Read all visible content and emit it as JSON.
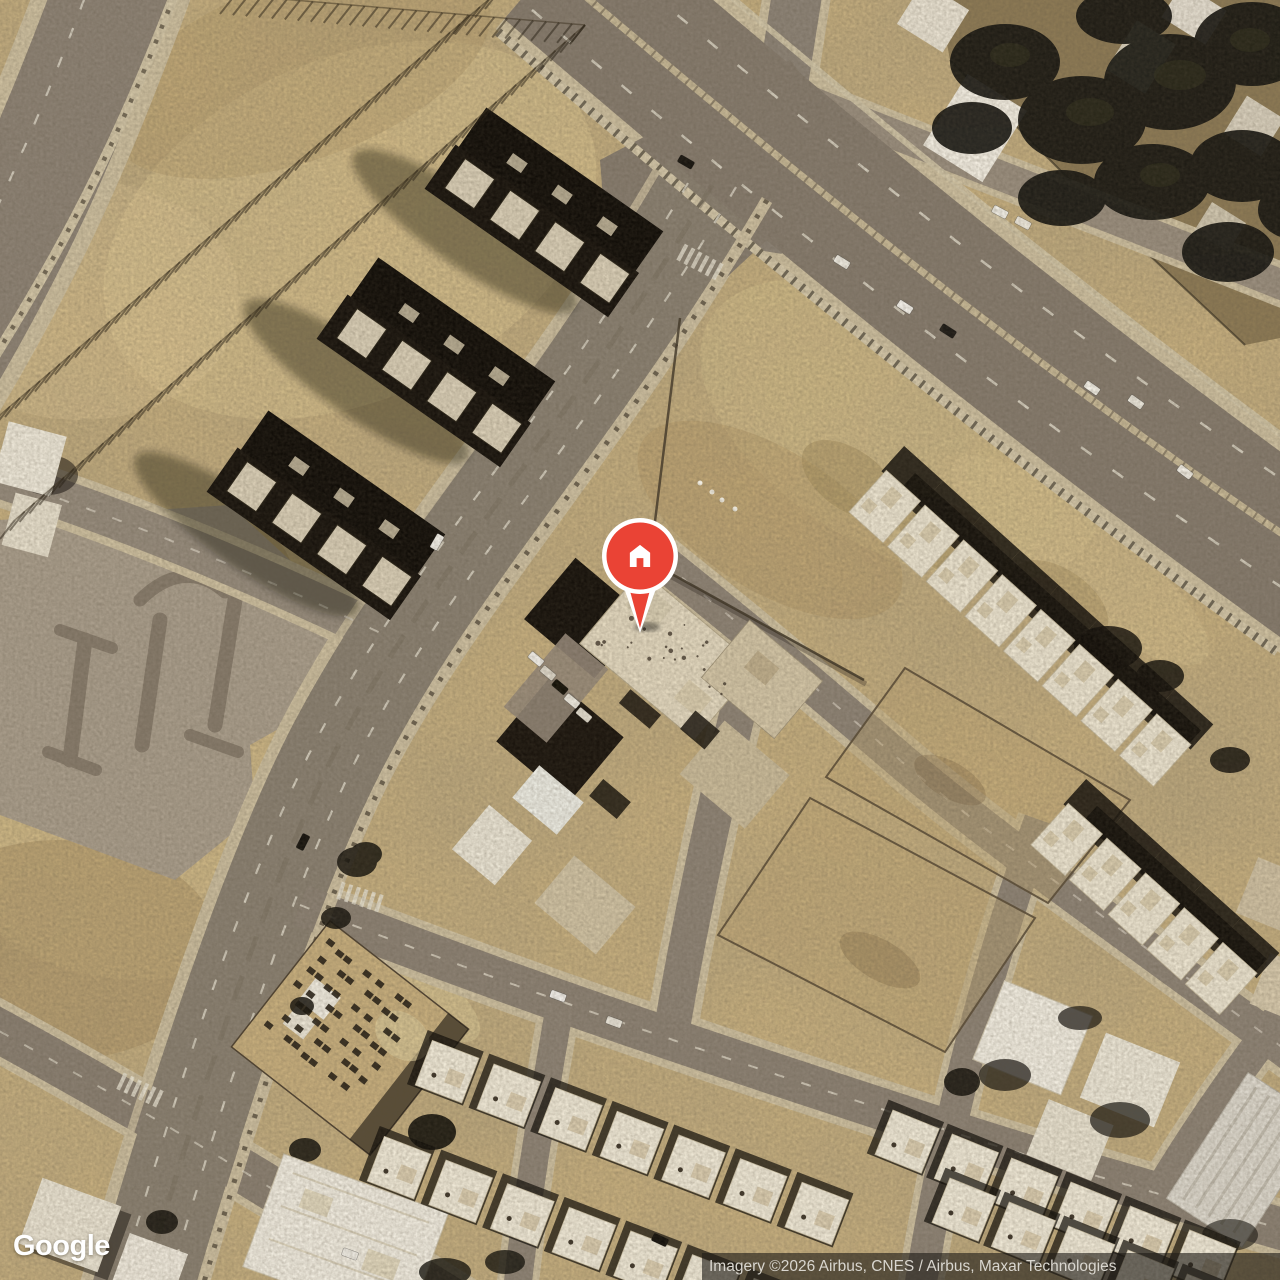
{
  "map": {
    "logo_text": "Google",
    "attribution": "Imagery ©2026 Airbus, CNES / Airbus, Maxar Technologies",
    "marker": {
      "type": "place-marker",
      "icon": "home-icon",
      "color": "#EA4335",
      "ring_color": "#ffffff",
      "x": 640,
      "tip_y": 633
    }
  },
  "colors": {
    "sand": "#c8b07f",
    "road": "#8a8071",
    "highway": "#867b6d",
    "sidewalk": "#cdbf9f",
    "building_shadow": "#15110b",
    "roof_light": "#efe9da",
    "tree": "#161510",
    "pin_red": "#EA4335"
  }
}
